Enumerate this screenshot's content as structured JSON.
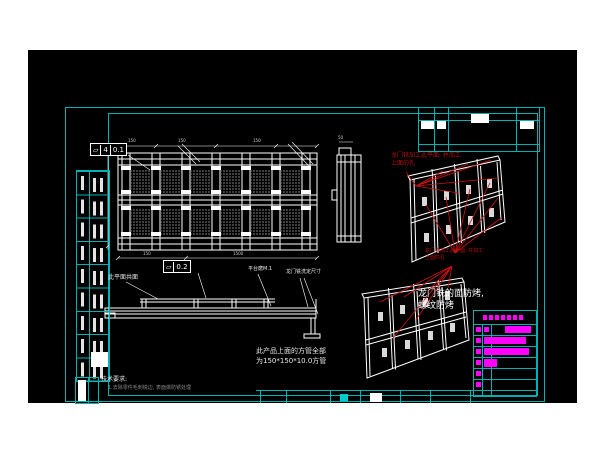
{
  "drawing": {
    "kind": "CAD engineering drawing sheet",
    "colors": {
      "page": "#ffffff",
      "model_background": "#000000",
      "sheet_frame": "#00b2b2",
      "geometry": "#ffffff",
      "red_annotation": "#b01010",
      "magenta_fields": "#ff00ff"
    },
    "gdt": {
      "flatness_top": {
        "symbol": "▱",
        "prefix": "4",
        "value": "0.1"
      },
      "flatness_mid": {
        "symbol": "▱",
        "value": "0.2"
      }
    },
    "labels": {
      "coplanar": "此平面共面",
      "platform": "平台磨M.1",
      "gantry_finish": "龙门铣洗定尺寸",
      "tech_req_title": "技术要求:",
      "tech_req_item": "1.去除零件毛刺锐边, 表面做防锈处理"
    },
    "notes": {
      "red_top_1": "龙门铣加工此平面, 并加工",
      "red_top_2": "上面的孔",
      "red_bottom_1": "龙门铣加工此平面, 并加工",
      "red_bottom_2": "上面的孔",
      "white_1": "龙门铣的面防烤,",
      "white_2": "螺纹防烤",
      "tube_1": "此产品上面的方管全部",
      "tube_2": "为150*150*10.0方管"
    },
    "dims": {
      "top1": "150",
      "top2": "150",
      "top3": "150",
      "bottom1": "150",
      "bottom2": "1500",
      "section": "50"
    }
  }
}
